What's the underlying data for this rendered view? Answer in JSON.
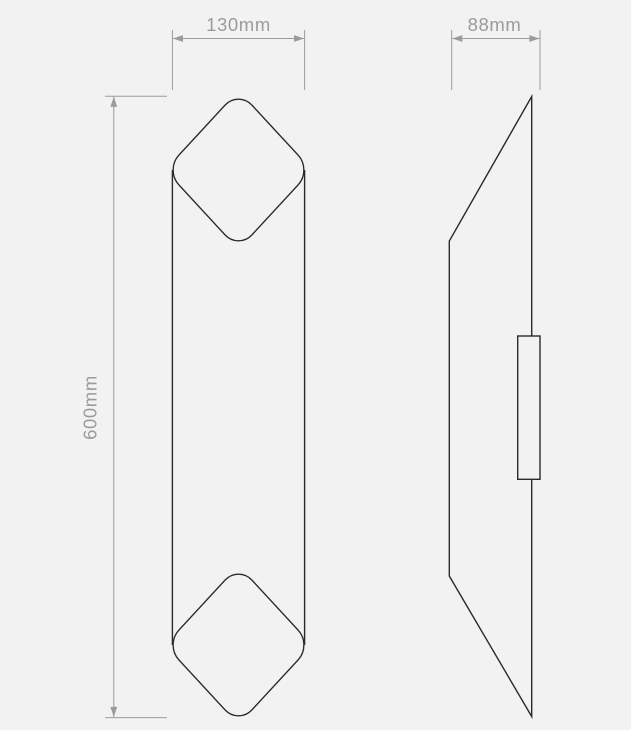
{
  "canvas": {
    "background": "#f2f2f2",
    "outline_color": "#2a2a2a",
    "dimension_color": "#9b9b9b"
  },
  "dimensions": {
    "width": {
      "label": "130mm"
    },
    "depth": {
      "label": "88mm"
    },
    "height": {
      "label": "600mm"
    }
  }
}
